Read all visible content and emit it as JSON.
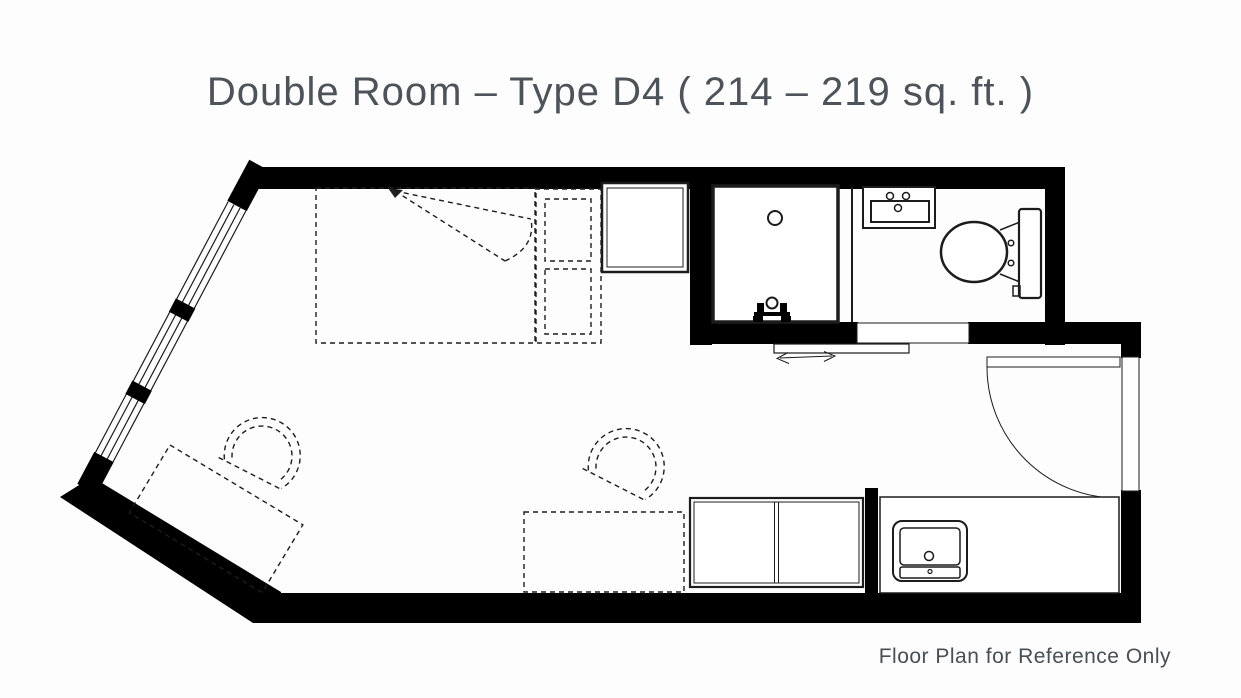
{
  "header": {
    "title": "Double Room – Type D4 ( 214 – 219 sq. ft. )"
  },
  "footer": {
    "note": "Floor Plan for Reference Only"
  },
  "colors": {
    "background": "#fdfdfd",
    "ink": "#000000",
    "line": "#1c1c1c",
    "title_text": "#4d535a",
    "footer_text": "#474e56"
  }
}
